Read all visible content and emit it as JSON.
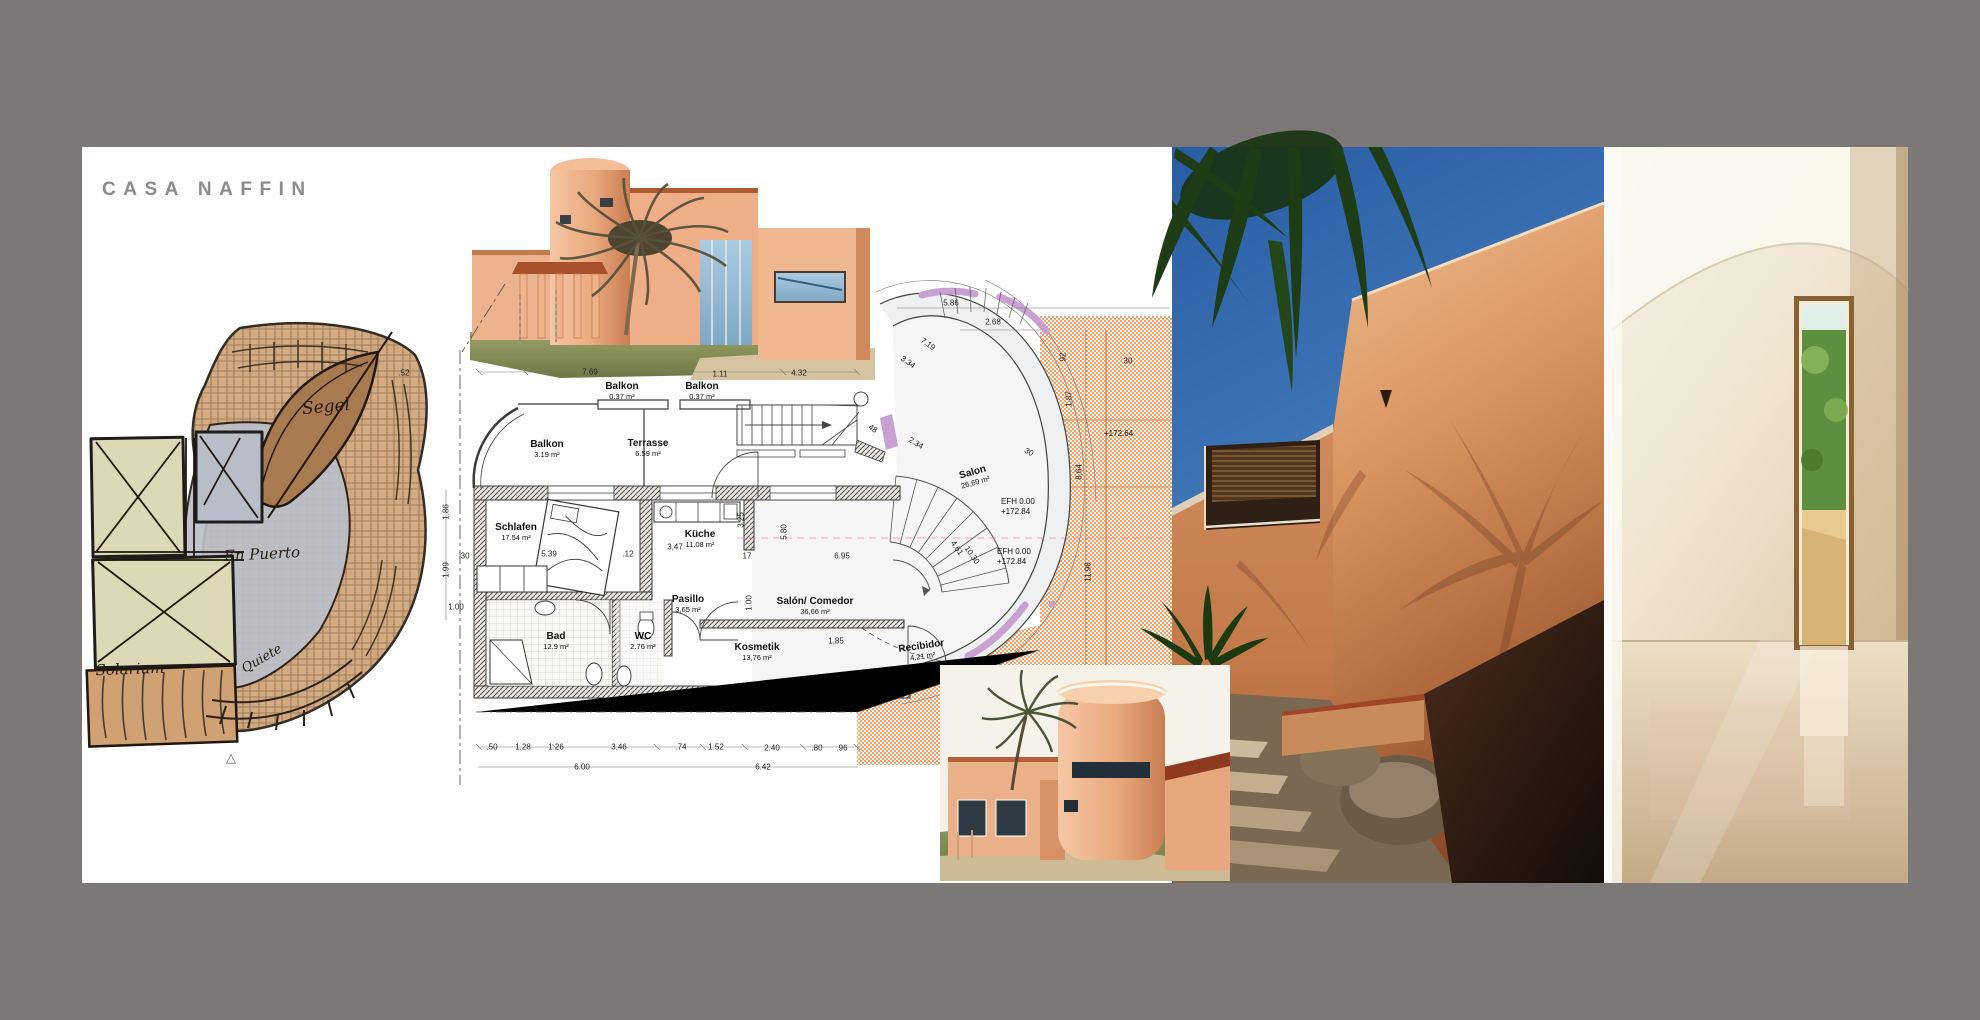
{
  "page": {
    "title": "CASA NAFFIN",
    "background_color": "#7b7877",
    "panel_color": "#ffffff",
    "title_color": "#8b8b8b"
  },
  "sketch": {
    "labels": {
      "sail": "Segel",
      "courtyard": "En Puerto",
      "solarium": "Solarium",
      "stairs": "Quiete"
    },
    "marker": "△"
  },
  "floor_plan": {
    "rooms": [
      {
        "name": "Balkon",
        "area": "0.37 m²"
      },
      {
        "name": "Balkon",
        "area": "0.37 m²"
      },
      {
        "name": "Balkon",
        "area": "3.19 m²"
      },
      {
        "name": "Terrasse",
        "area": "6.59 m²"
      },
      {
        "name": "Schlafen",
        "area": "17.54 m²"
      },
      {
        "name": "Küche",
        "area": "11.08 m²"
      },
      {
        "name": "Pasillo",
        "area": "3,65 m²"
      },
      {
        "name": "Bad",
        "area": "12.9 m²"
      },
      {
        "name": "WC",
        "area": "2.76 m²"
      },
      {
        "name": "Kosmetik",
        "area": "13,76 m²"
      },
      {
        "name": "Salón/ Comedor",
        "area": "36,66 m²"
      },
      {
        "name": "Salon",
        "area": "26,69 m²"
      },
      {
        "name": "Recibidor",
        "area": "4,21 m²"
      }
    ],
    "levels": [
      {
        "label": "EFH 0.00",
        "value": "+172.84"
      },
      {
        "label": "EFH 0.00",
        "value": "+172.84"
      }
    ],
    "terrain_level": "+172.64",
    "dims": [
      ".52",
      "7.69",
      "1.11",
      "4.32",
      "5.86",
      "2.68",
      "7.19",
      "3.34",
      "1.86",
      "1.99",
      ".30",
      "1.00",
      "5.39",
      ".12",
      "3,47",
      "3.25",
      "17",
      "5.80",
      "6.95",
      "1.00",
      "2.34",
      ".48",
      "1,85",
      "30",
      "30",
      "92",
      "1.87",
      "8.64",
      "11.98",
      "4.61",
      "10.30",
      ".50",
      "1.28",
      "1.26",
      "3.46",
      ".74",
      "1.52",
      "2.40",
      ".80",
      ".96",
      "6.00",
      "6.42"
    ],
    "accent_colors": {
      "glazing_purple": "#c9a0d2",
      "terrain_orange": "#eca26b",
      "axis_pink": "#f06a9a"
    }
  },
  "photos": {
    "exterior": {
      "palette": {
        "sky": "#2a5ca4",
        "wall": "#d9945f",
        "palm": "#1e3c15"
      }
    },
    "interior": {
      "palette": {
        "wall": "#f0e8d6",
        "floor": "#d9c5a3",
        "garden": "#6f9c43"
      }
    }
  }
}
